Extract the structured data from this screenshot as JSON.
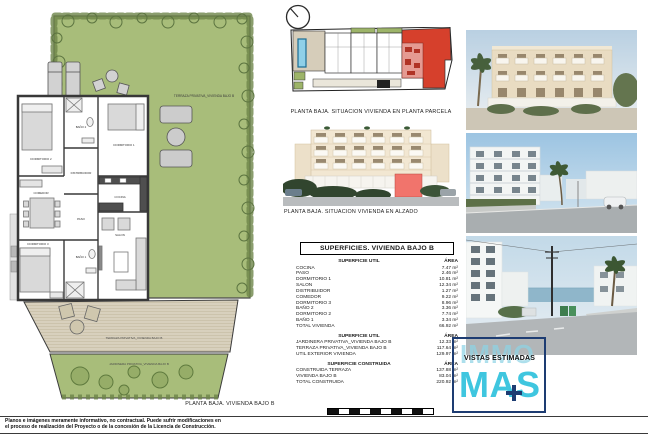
{
  "captions": {
    "site_plan": "PLANTA BAJA. SITUACION VIVIENDA EN PLANTA PARCELA",
    "elevation": "PLANTA BAJA. SITUACION VIVIENDA EN ALZADO",
    "floor_plan": "PLANTA BAJA. VIVIENDA BAJO B"
  },
  "floor_plan": {
    "labels": {
      "garden": "TERRAZA PRIVATIVA_VIVIENDA BAJO B",
      "deck": "TERRAZA PRIVATIVA_VIVIENDA BAJO B",
      "jardinera": "JARDINERA PRIVATIVA_VIVIENDA BAJO B",
      "dormitorio1": "DORMITORIO 1",
      "dormitorio2": "DORMITORIO 2",
      "dormitorio3": "DORMITORIO 3",
      "bano1": "BAÑO 1",
      "bano2": "BAÑO 2",
      "salon": "SALON",
      "comedor": "COMEDOR",
      "cocina": "COCINA",
      "paso": "PASO",
      "distribuidor": "DISTRIBUIDOR"
    }
  },
  "surfaces_table": {
    "title": "SUPERFICIES. VIVIENDA BAJO B",
    "sections": [
      {
        "header": "SUPERFICIE UTIL",
        "area_header": "ÁREA",
        "rows": [
          {
            "label": "COCINA",
            "value": "7.47 m²"
          },
          {
            "label": "PASO",
            "value": "2.46 m²"
          },
          {
            "label": "DORMITORIO 1",
            "value": "10.81 m²"
          },
          {
            "label": "SALON",
            "value": "12.34 m²"
          },
          {
            "label": "DISTRIBUIDOR",
            "value": "1.27 m²"
          },
          {
            "label": "COMEDOR",
            "value": "9.22 m²"
          },
          {
            "label": "DORMITORIO 3",
            "value": "8.96 m²"
          },
          {
            "label": "BAÑO 2",
            "value": "3.36 m²"
          },
          {
            "label": "DORMITORIO 2",
            "value": "7.74 m²"
          },
          {
            "label": "BAÑO 1",
            "value": "3.34 m²"
          },
          {
            "label": "TOTAL VIVIENDA",
            "value": "66.92 m²"
          }
        ]
      },
      {
        "header": "SUPERFICIE UTIL",
        "area_header": "ÁREA",
        "rows": [
          {
            "label": "JARDINERA PRIVATIVA_VIVIENDA BAJO B",
            "value": "12.33 m²"
          },
          {
            "label": "TERRAZA PRIVATIVA_VIVIENDA BAJO B",
            "value": "117.64 m²"
          },
          {
            "label": "UTIL EXTERIOR VIVIENDA",
            "value": "129.97 m²"
          }
        ]
      },
      {
        "header": "SUPERFICIE CONSTRUIDA",
        "area_header": "ÁREA",
        "rows": [
          {
            "label": "CONSTRUIDA TERRAZA",
            "value": "137.88 m²"
          },
          {
            "label": "VIVIENDA BAJO B",
            "value": "83.04 m²"
          },
          {
            "label": "TOTAL CONSTRUIDA",
            "value": "220.92 m²"
          }
        ]
      }
    ]
  },
  "branding": {
    "immo": "IMMO",
    "mas": "MAS",
    "vistas_estimadas": "VISTAS ESTIMADAS",
    "colors": {
      "cyan": "#3fc6df",
      "navy": "#1d3c72"
    }
  },
  "footer": {
    "disclaimer_line1": "Planos e imágenes meramente informativo, no contractual. Puede sufrir modificaciones en",
    "disclaimer_line2": "el proceso de realización del Proyecto o de la concesión de la Licencia de Construcción."
  },
  "colors": {
    "highlight_red": "#d6402c",
    "highlight_salmon": "#f1746c",
    "garden_green": "#a8bd7a",
    "terrace_beige": "#d8d0bd"
  }
}
